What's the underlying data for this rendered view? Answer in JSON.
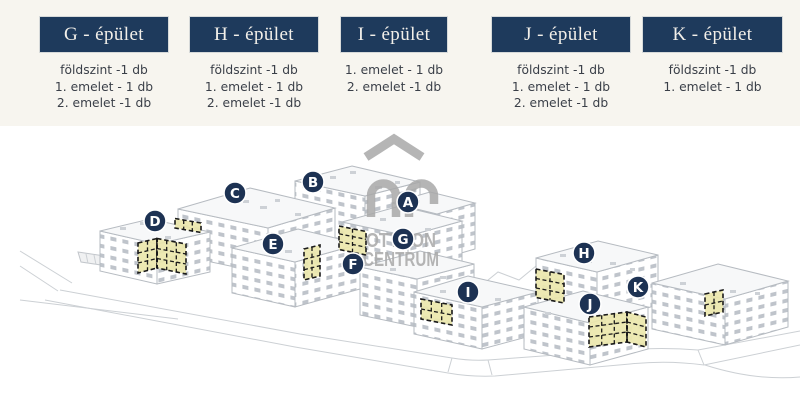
{
  "header": {
    "columns": [
      {
        "label": "G - épület",
        "items": [
          "földszint -1 db",
          "1. emelet - 1 db",
          "2. emelet -1 db"
        ]
      },
      {
        "label": "H - épület",
        "items": [
          "földszint -1 db",
          "1. emelet - 1 db",
          "2. emelet -1 db"
        ]
      },
      {
        "label": "I - épület",
        "items": [
          "1. emelet - 1 db",
          "2. emelet -1 db"
        ]
      },
      {
        "label": "J - épület",
        "items": [
          "földszint -1 db",
          "1. emelet - 1 db",
          "2. emelet -1 db"
        ]
      },
      {
        "label": "K - épület",
        "items": [
          "földszint -1 db",
          "1. emelet - 1 db"
        ]
      }
    ]
  },
  "map": {
    "markers": [
      {
        "letter": "A"
      },
      {
        "letter": "B"
      },
      {
        "letter": "C"
      },
      {
        "letter": "D"
      },
      {
        "letter": "E"
      },
      {
        "letter": "F"
      },
      {
        "letter": "G"
      },
      {
        "letter": "H"
      },
      {
        "letter": "I"
      },
      {
        "letter": "J"
      },
      {
        "letter": "K"
      }
    ],
    "watermark": {
      "line1": "OTTHON",
      "line2": "CENTRUM"
    }
  },
  "colors": {
    "button_navy": "#1e3a5c",
    "header_cream": "#f7f5ef",
    "marker_navy": "#1d3253",
    "highlight_yellow": "#ebe7ad",
    "watermark_gray": "#a9a9a9",
    "lineart_gray": "#b6bbc1",
    "list_text": "#3a3f48"
  }
}
